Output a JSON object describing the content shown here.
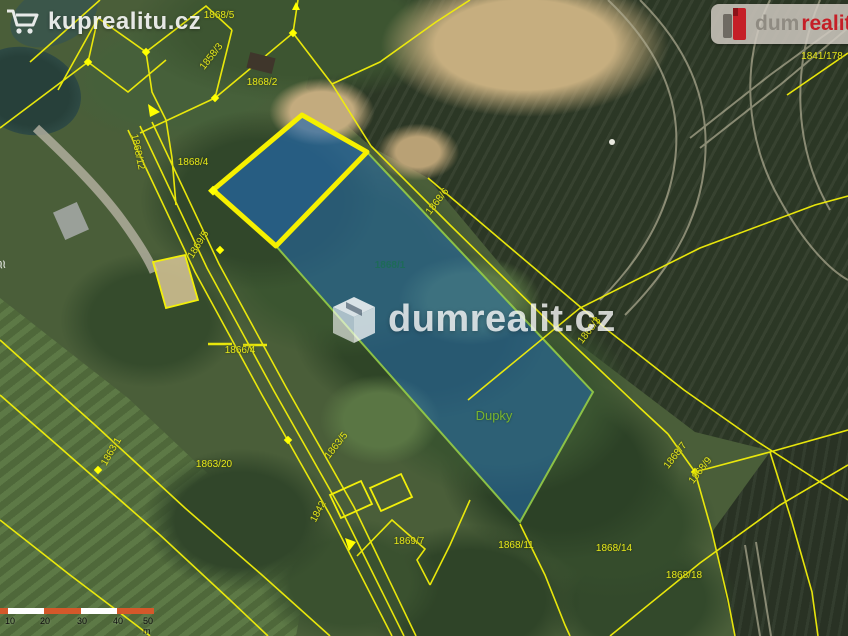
{
  "watermark_topleft": {
    "text": "kuprealitu.cz",
    "icon": "shopping-cart-icon"
  },
  "watermark_center": {
    "text": "dumrealit.cz",
    "icon": "house-box-icon"
  },
  "logo_topright": {
    "part1": "dum",
    "part2": "realit"
  },
  "map": {
    "highlight_parcel_fill": "#2369af",
    "highlight_border_thick": "#f6f000",
    "cadastral_line_color": "#f2ef0a",
    "labels": [
      {
        "text": "1868/5"
      },
      {
        "text": "1858/3"
      },
      {
        "text": "1868/2"
      },
      {
        "text": "1841/178"
      },
      {
        "text": "1868/12"
      },
      {
        "text": "1868/4"
      },
      {
        "text": "1869/5"
      },
      {
        "text": "1868/6"
      },
      {
        "text": "1868/1"
      },
      {
        "text": "1868/3"
      },
      {
        "text": "1866/4"
      },
      {
        "text": "Dupky"
      },
      {
        "text": "1863/1"
      },
      {
        "text": "1863/20"
      },
      {
        "text": "1863/5"
      },
      {
        "text": "1842"
      },
      {
        "text": "1869/7"
      },
      {
        "text": "1868/11"
      },
      {
        "text": "1868/14"
      },
      {
        "text": "1868/18"
      },
      {
        "text": "1868/7"
      },
      {
        "text": "1868/9"
      }
    ]
  },
  "scalebar": {
    "ticks": [
      "10",
      "20",
      "30",
      "40",
      "50 m"
    ],
    "color_segment": "#d4582a",
    "color_alt": "#ffffff"
  }
}
